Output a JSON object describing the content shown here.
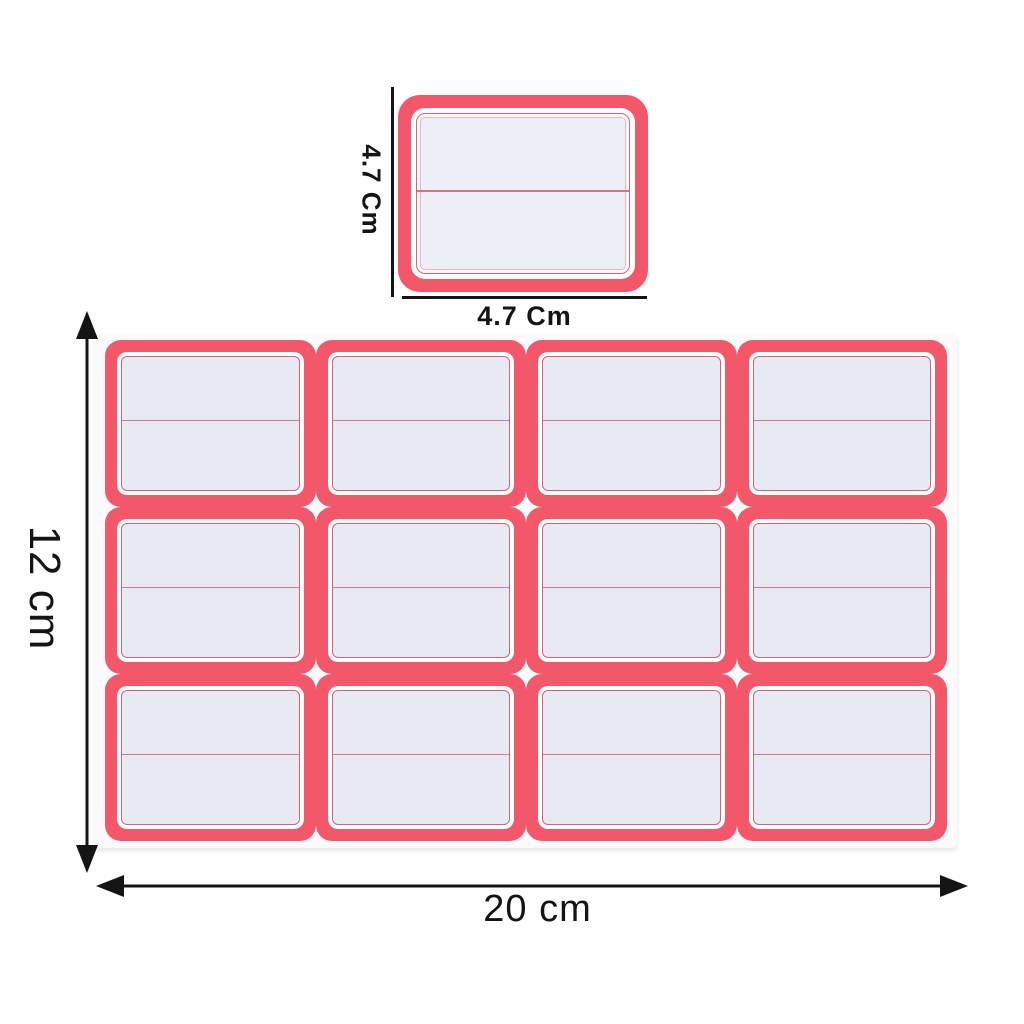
{
  "product": {
    "small_label": {
      "height_label": "4.7 Cm",
      "width_label": "4.7 Cm"
    },
    "sheet": {
      "height_label": "12 cm",
      "width_label": "20 cm",
      "rows": 3,
      "columns": 4,
      "label_count": 12
    },
    "colors": {
      "border_red": "#f2586a",
      "inner_line_red": "#cf6571",
      "label_fill": "#e8eaf3",
      "small_label_fill": "#eef0f7",
      "sheet_white": "#fbfbfd",
      "dimension_black": "#141414"
    }
  }
}
